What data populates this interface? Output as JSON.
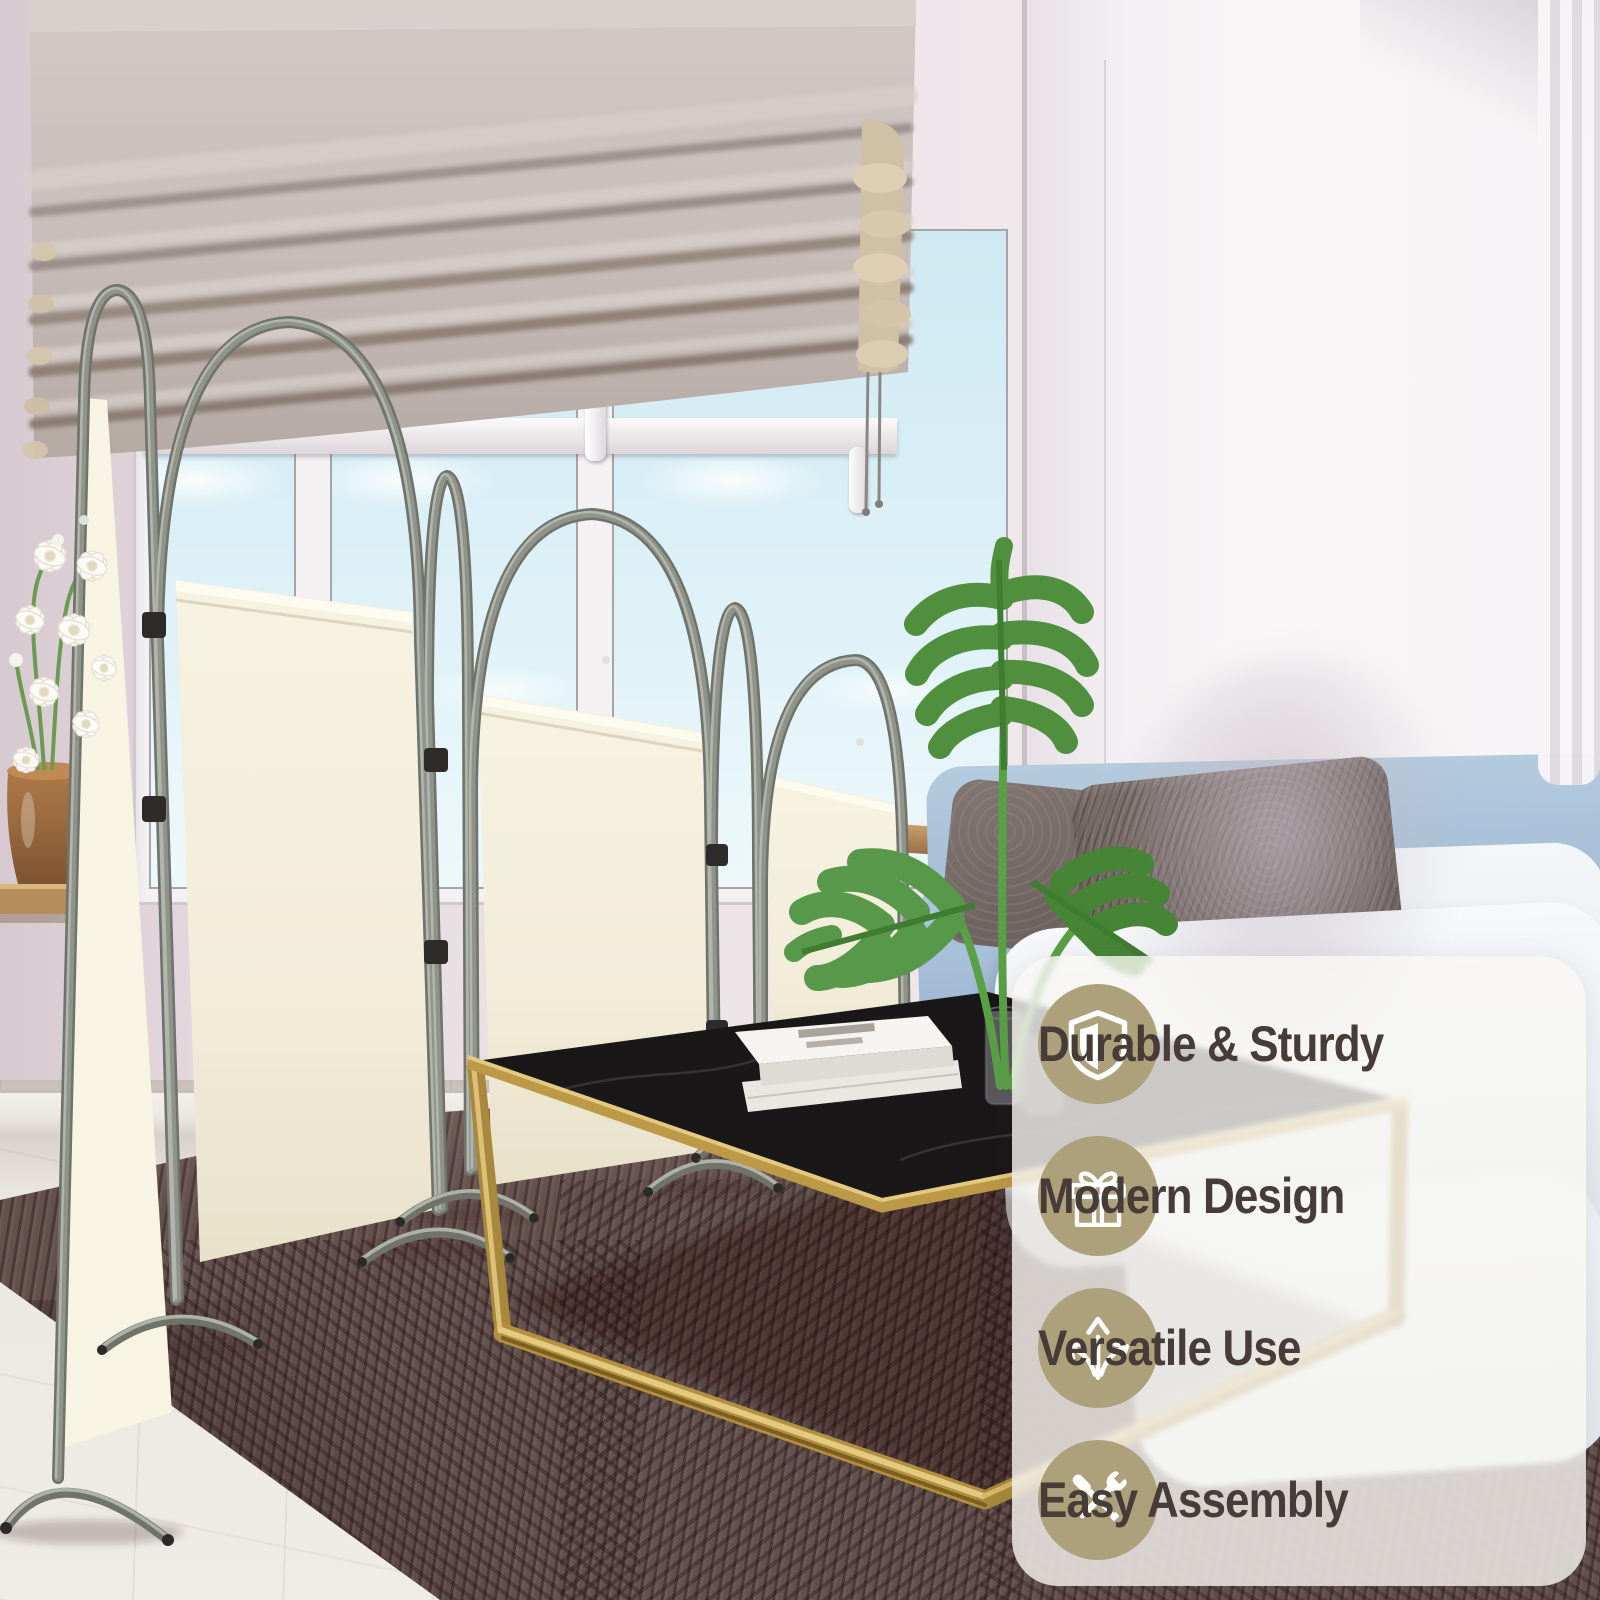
{
  "type": "product-lifestyle-photo",
  "subject": "4-panel folding room divider privacy screen in a living room",
  "overlay_panel": {
    "features": [
      {
        "icon": "shield-icon",
        "label": "Durable & Sturdy"
      },
      {
        "icon": "gift-icon",
        "label": "Modern Design"
      },
      {
        "icon": "arrows-icon",
        "label": "Versatile Use"
      },
      {
        "icon": "tools-icon",
        "label": "Easy Assembly"
      }
    ]
  },
  "colors": {
    "tan": "#ada17b",
    "feature_text": "#473c37",
    "panel_bg": "rgba(248,246,243,0.8)",
    "icon_glyph": "#ffffff",
    "divider_fabric": "#f4efdd",
    "divider_frame": "#80847b",
    "rug": "#64504d",
    "sofa_blue": "#a7c0da",
    "cushion_white": "#eff2f5",
    "table_gold": "#b29040",
    "table_marble": "#1a1719",
    "plant_green": "#4f8f3e",
    "shade_fabric": "#c9beba",
    "wall_pink": "#e4d9de",
    "wall_white": "#f6f3f5",
    "tile_floor": "#ebe8e1"
  }
}
